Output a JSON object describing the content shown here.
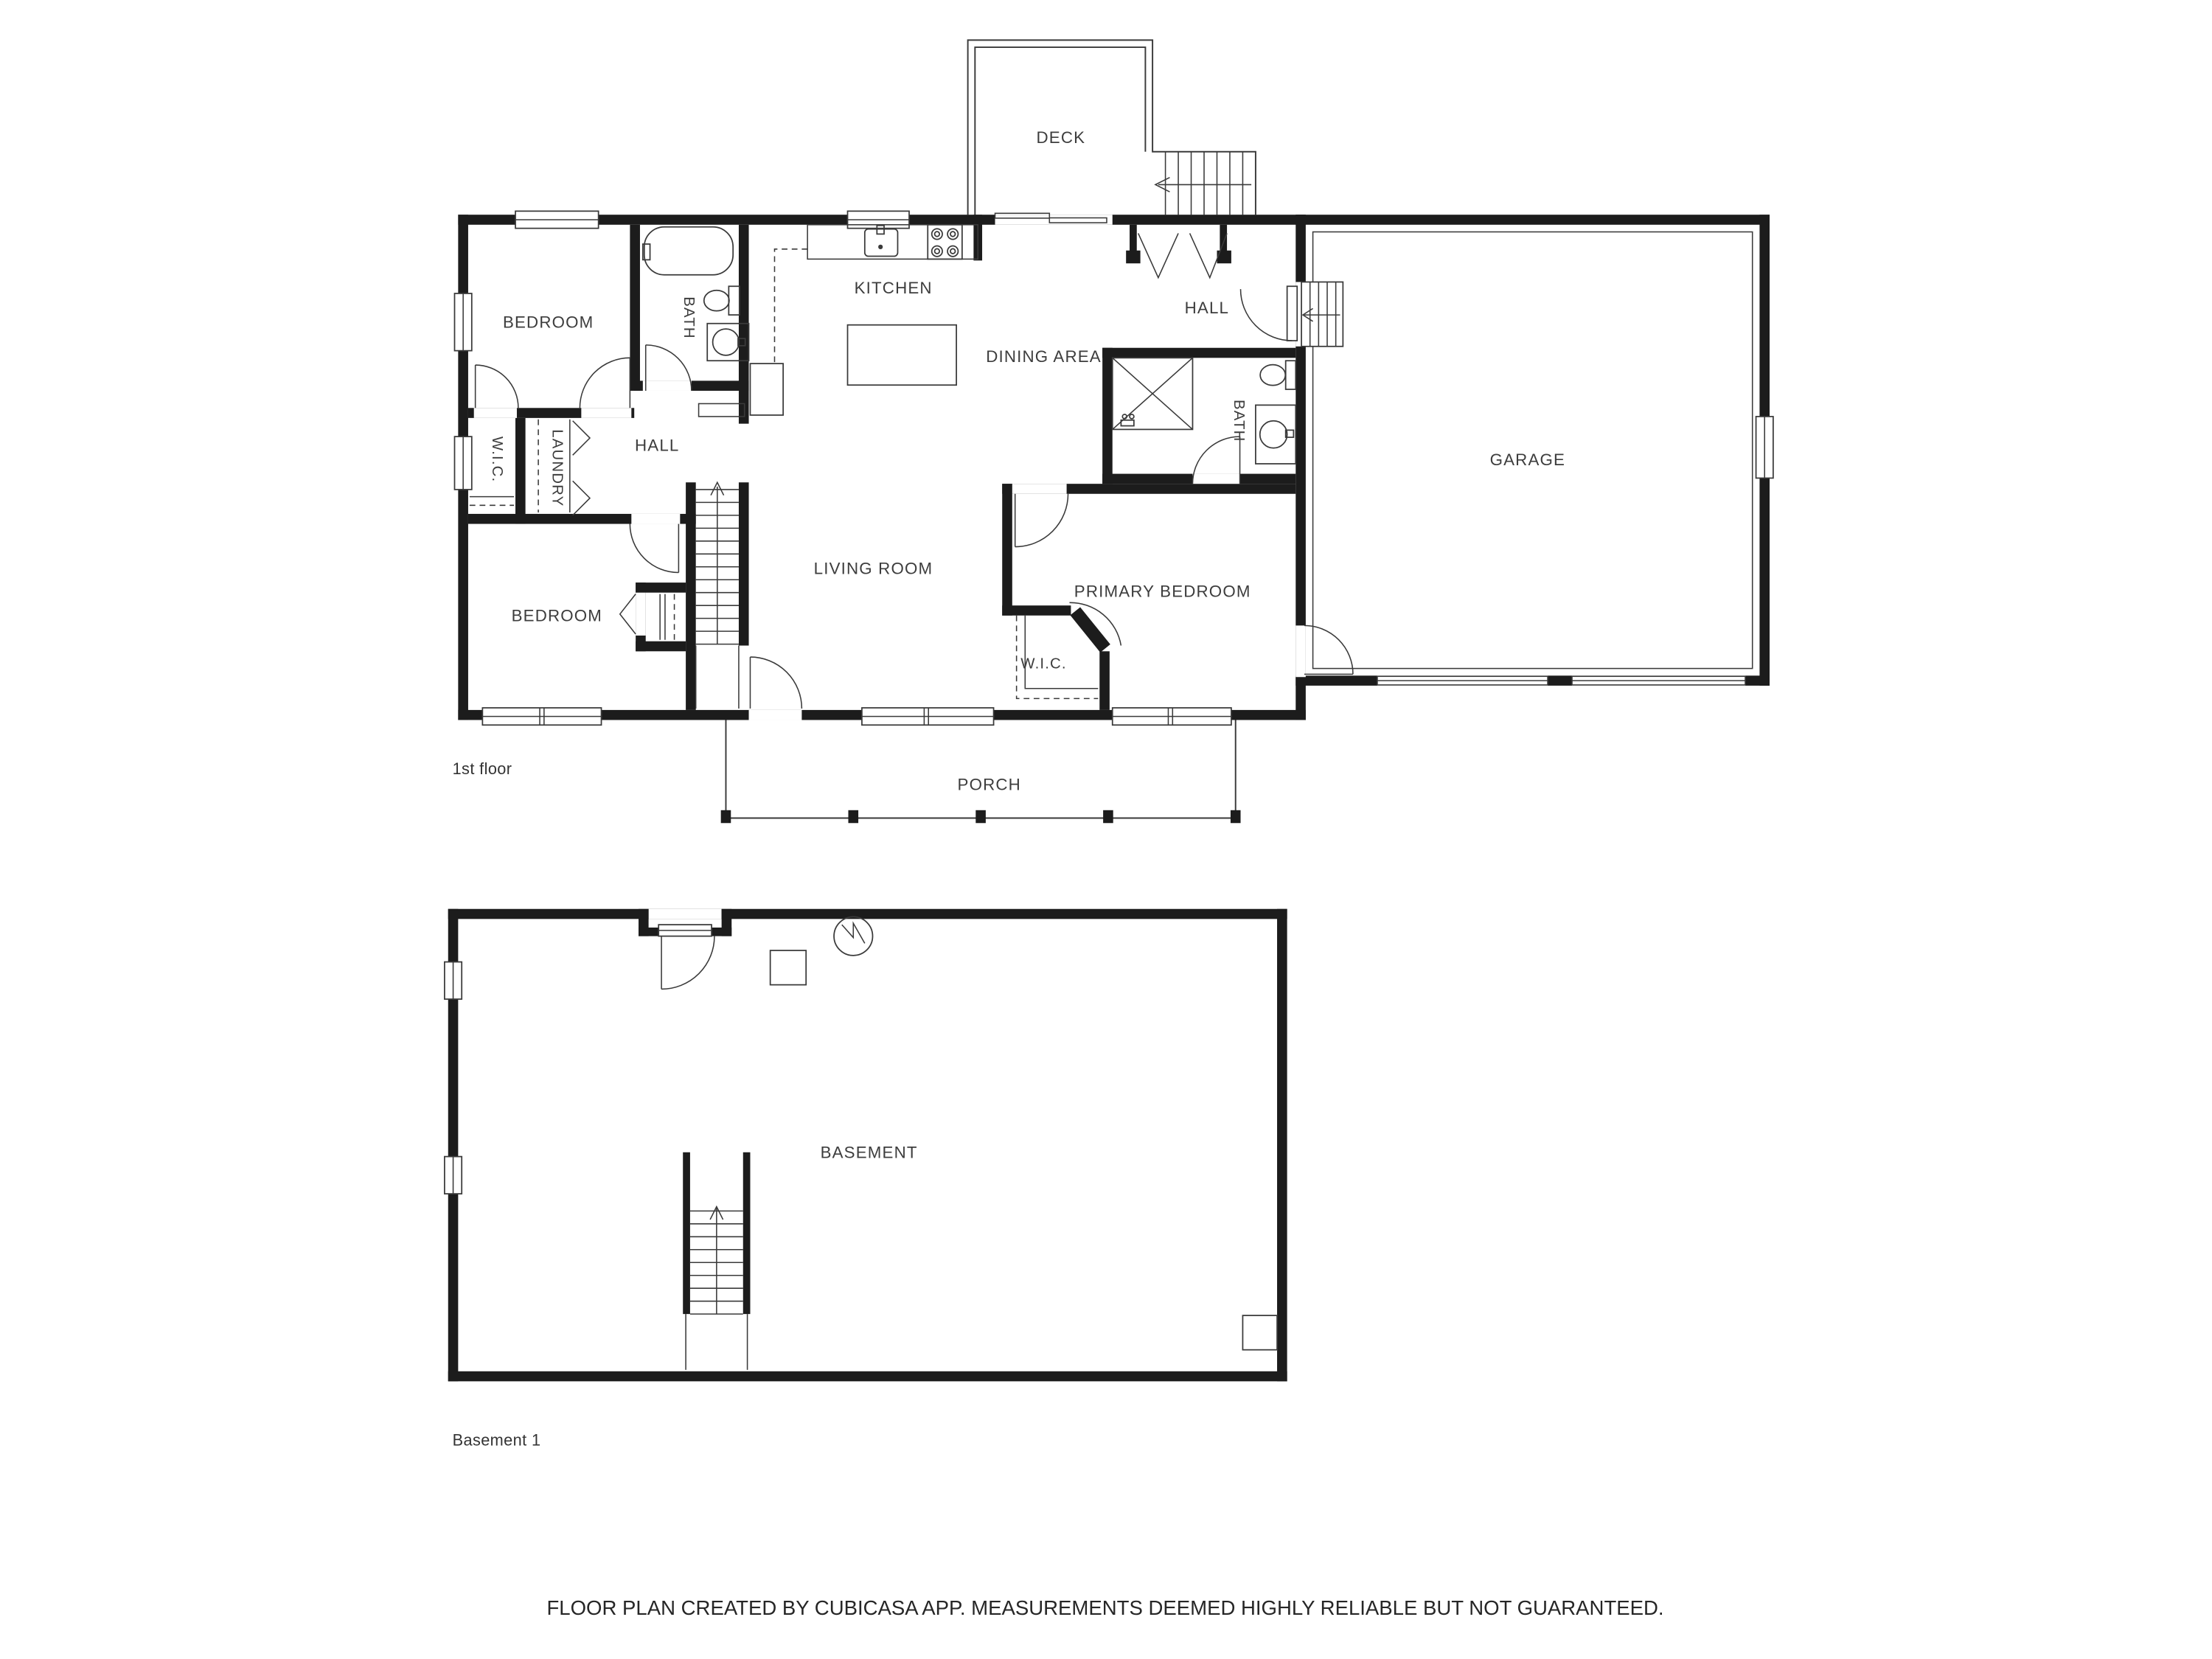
{
  "floor_1": {
    "name": "1st floor",
    "rooms": {
      "bedroom_top": "BEDROOM",
      "bath_main": "BATH",
      "kitchen": "KITCHEN",
      "hall_upper": "HALL",
      "dining": "DINING AREA",
      "garage": "GARAGE",
      "wic_left": "W.I.C.",
      "laundry": "LAUNDRY",
      "hall_inner": "HALL",
      "living": "LIVING ROOM",
      "bedroom_lower": "BEDROOM",
      "primary": "PRIMARY BEDROOM",
      "wic_primary": "W.I.C.",
      "bath_second": "BATH",
      "deck": "DECK",
      "porch": "PORCH"
    }
  },
  "basement": {
    "name": "Basement 1",
    "rooms": {
      "basement": "BASEMENT"
    }
  },
  "footer": {
    "disclaimer": "FLOOR PLAN CREATED BY CUBICASA APP. MEASUREMENTS DEEMED HIGHLY RELIABLE BUT NOT GUARANTEED."
  },
  "colors": {
    "walls": "#1c1c1c",
    "thin_lines": "#3a3a3a",
    "labels": "#3d3d3d",
    "background": "#ffffff"
  }
}
